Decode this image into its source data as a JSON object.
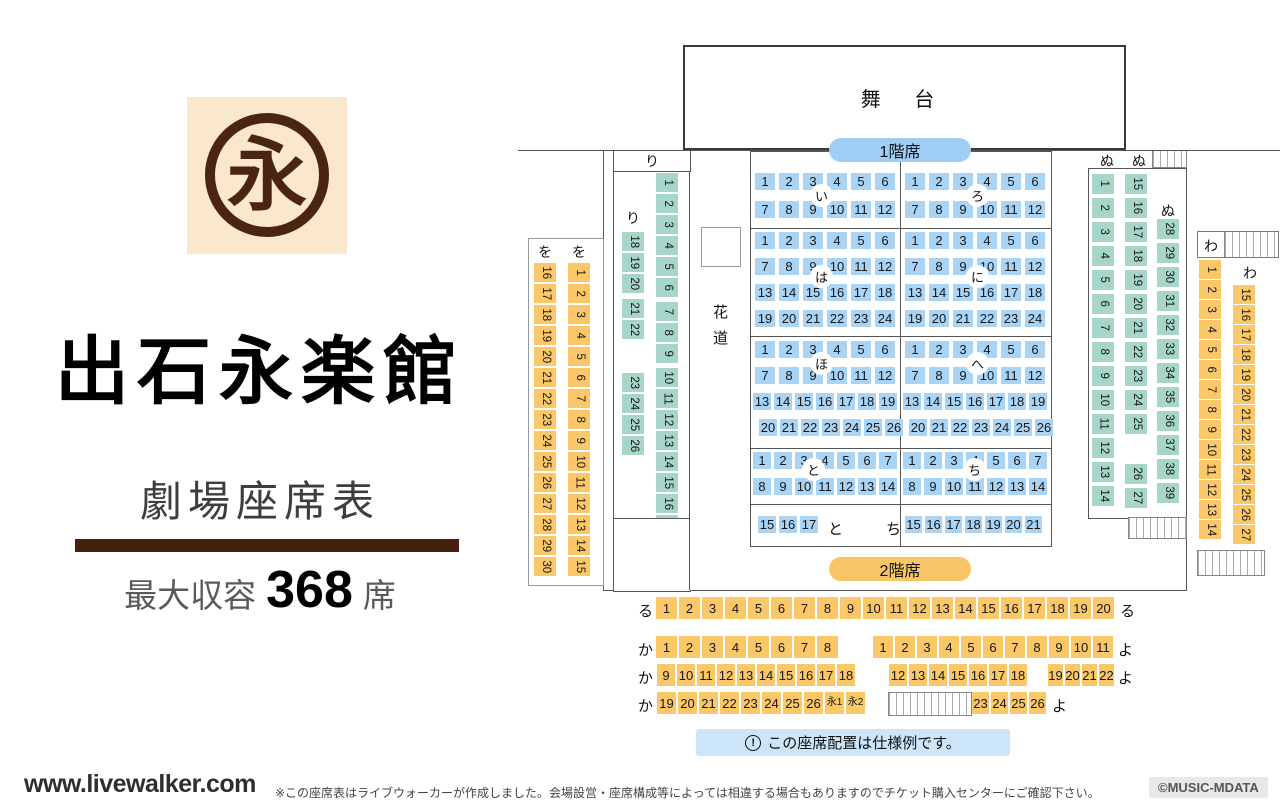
{
  "branding": {
    "logo_char": "永",
    "title": "出石永楽館",
    "subtitle": "劇場座席表",
    "capacity_label": "最大収容",
    "capacity_value": "368",
    "capacity_unit": "席"
  },
  "footer": {
    "site": "www.livewalker.com",
    "disclaimer": "※この座席表はライブウォーカーが作成しました。会場設営・座席構成等によっては相違する場合もありますのでチケット購入センターにご確認下さい。",
    "credit": "©MUSIC-MDATA"
  },
  "map": {
    "stage": "舞 台",
    "floor1": "1階席",
    "floor2": "2階席",
    "hanamichi_1": "花",
    "hanamichi_2": "道",
    "note": "この座席配置は仕様例です。",
    "note_icon": "!",
    "blocks": {
      "wo": {
        "header1": "を",
        "header2": "を",
        "col1": [
          16,
          17,
          18,
          19,
          20,
          21,
          22,
          23,
          24,
          25,
          26,
          27,
          28,
          29,
          30
        ],
        "col2": [
          1,
          2,
          3,
          4,
          5,
          6,
          7,
          8,
          9,
          10,
          11,
          12,
          13,
          14,
          15
        ]
      },
      "ri": {
        "header": "り",
        "side_label": "り",
        "left_groups": [
          [
            18,
            19,
            20
          ],
          [
            21,
            22
          ],
          [
            23,
            24,
            25,
            26
          ]
        ],
        "right_groups": [
          [
            1,
            2,
            3,
            4,
            5,
            6
          ],
          [
            7,
            8,
            9
          ],
          [
            10,
            11,
            12,
            13,
            14,
            15,
            16,
            17
          ]
        ]
      },
      "i": {
        "label": "い",
        "rows": [
          [
            1,
            2,
            3,
            4,
            5,
            6
          ],
          [
            7,
            8,
            9,
            10,
            11,
            12
          ]
        ]
      },
      "ro": {
        "label": "ろ",
        "rows": [
          [
            1,
            2,
            3,
            4,
            5,
            6
          ],
          [
            7,
            8,
            9,
            10,
            11,
            12
          ]
        ]
      },
      "ha": {
        "label": "は",
        "rows": [
          [
            1,
            2,
            3,
            4,
            5,
            6
          ],
          [
            7,
            8,
            9,
            10,
            11,
            12
          ],
          [
            13,
            14,
            15,
            16,
            17,
            18
          ],
          [
            19,
            20,
            21,
            22,
            23,
            24
          ]
        ]
      },
      "ni": {
        "label": "に",
        "rows": [
          [
            1,
            2,
            3,
            4,
            5,
            6
          ],
          [
            7,
            8,
            9,
            10,
            11,
            12
          ],
          [
            13,
            14,
            15,
            16,
            17,
            18
          ],
          [
            19,
            20,
            21,
            22,
            23,
            24
          ]
        ]
      },
      "ho": {
        "label": "ほ",
        "rows": [
          [
            1,
            2,
            3,
            4,
            5,
            6
          ],
          [
            7,
            8,
            9,
            10,
            11,
            12
          ],
          [
            13,
            14,
            15,
            16,
            17,
            18,
            19
          ],
          [
            20,
            21,
            22,
            23,
            24,
            25,
            26
          ]
        ]
      },
      "he": {
        "label": "へ",
        "rows": [
          [
            1,
            2,
            3,
            4,
            5,
            6
          ],
          [
            7,
            8,
            9,
            10,
            11,
            12
          ],
          [
            13,
            14,
            15,
            16,
            17,
            18,
            19
          ],
          [
            20,
            21,
            22,
            23,
            24,
            25,
            26
          ]
        ]
      },
      "to": {
        "label": "と",
        "rows": [
          [
            1,
            2,
            3,
            4,
            5,
            6,
            7
          ],
          [
            8,
            9,
            10,
            11,
            12,
            13,
            14
          ]
        ],
        "last_row": [
          15,
          16,
          17
        ],
        "last_label": "と"
      },
      "chi": {
        "label": "ち",
        "rows": [
          [
            1,
            2,
            3,
            4,
            5,
            6,
            7
          ],
          [
            8,
            9,
            10,
            11,
            12,
            13,
            14
          ]
        ],
        "last_row": [
          15,
          16,
          17,
          18,
          19,
          20,
          21
        ],
        "last_label": "ち"
      },
      "nu": {
        "header1": "ぬ",
        "header2": "ぬ",
        "header3": "ぬ",
        "col1": [
          1,
          2,
          3,
          4,
          5,
          6,
          7,
          8,
          9,
          10,
          11,
          12,
          13,
          14
        ],
        "col2_groups": [
          [
            15,
            16,
            17,
            18,
            19,
            20,
            21,
            22,
            23,
            24,
            25
          ],
          [
            26,
            27
          ]
        ],
        "col3": [
          28,
          29,
          30,
          31,
          32,
          33,
          34,
          35,
          36,
          37,
          38,
          39
        ]
      },
      "wa": {
        "header": "わ",
        "side_label": "わ",
        "col1": [
          1,
          2,
          3,
          4,
          5,
          6,
          7,
          8,
          9,
          10,
          11,
          12,
          13,
          14
        ],
        "col2": [
          15,
          16,
          17,
          18,
          19,
          20,
          21,
          22,
          23,
          24,
          25,
          26,
          27
        ]
      },
      "ru": {
        "label_left": "る",
        "label_right": "る",
        "seats": [
          1,
          2,
          3,
          4,
          5,
          6,
          7,
          8,
          9,
          10,
          11,
          12,
          13,
          14,
          15,
          16,
          17,
          18,
          19,
          20
        ]
      },
      "ka_yo": {
        "row1": {
          "left_label": "か",
          "left": [
            1,
            2,
            3,
            4,
            5,
            6,
            7,
            8
          ],
          "right": [
            1,
            2,
            3,
            4,
            5,
            6,
            7,
            8,
            9,
            10,
            11
          ],
          "right_label": "よ"
        },
        "row2": {
          "left_label": "か",
          "left": [
            9,
            10,
            11,
            12,
            13,
            14,
            15,
            16,
            17,
            18
          ],
          "mid": [
            12,
            13,
            14,
            15,
            16,
            17,
            18
          ],
          "right": [
            19,
            20,
            21,
            22
          ],
          "right_label": "よ"
        },
        "row3": {
          "left_label": "か",
          "left": [
            19,
            20,
            21,
            22,
            23,
            24,
            25,
            26,
            "永1",
            "永2"
          ],
          "right": [
            23,
            24,
            25,
            26
          ],
          "right_label": "よ"
        }
      }
    }
  },
  "colors": {
    "seat_blue": "#a9d4f6",
    "seat_green": "#a8d5c9",
    "seat_orange": "#fbc869",
    "pill_blue": "#9ecdf5",
    "pill_orange": "#f8c566",
    "note_bg": "#cde5f8",
    "brand_brown": "#45200e",
    "logo_bg": "#fbe7cb",
    "logo_brown": "#4a2513"
  }
}
